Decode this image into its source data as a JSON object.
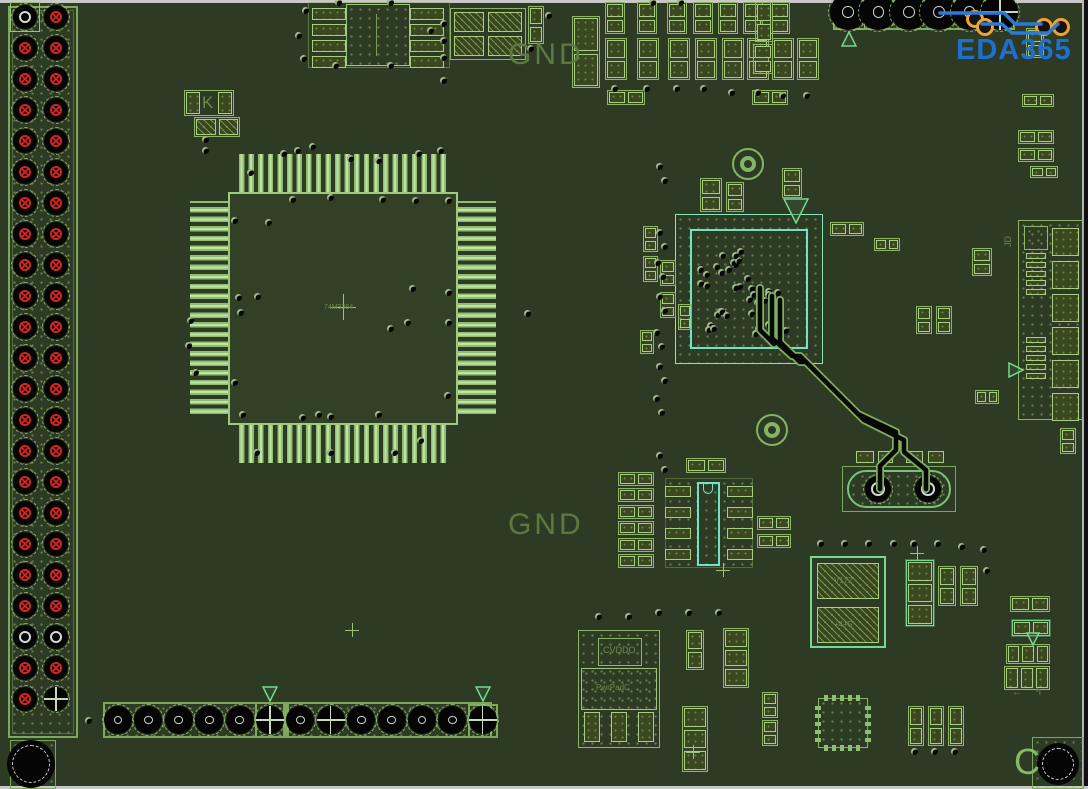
{
  "colors": {
    "board": "#2e3b24",
    "outline": "#8fb468",
    "bright": "#74da90",
    "cyan": "#6fe3c3",
    "silkscreen": "#5c7a40",
    "red_pad": "#d42525",
    "orange_via": "#f0a332",
    "blue_trace": "#2b79d8",
    "logo_blue": "#1d6fd2",
    "black": "#070707",
    "white_ring": "#d8d8d8"
  },
  "labels": {
    "gnd_top": "GND",
    "gnd_bottom": "GND",
    "logo": "EDA365"
  },
  "micro_labels": [
    {
      "text": "CVDDO",
      "x": 603,
      "y": 646,
      "size": 9
    },
    {
      "text": "PwrPadC",
      "x": 596,
      "y": 684,
      "size": 8
    },
    {
      "text": "V172",
      "x": 834,
      "y": 577,
      "size": 8
    },
    {
      "text": "+4+5",
      "x": 834,
      "y": 621,
      "size": 8
    },
    {
      "text": "74M9364",
      "x": 324,
      "y": 304,
      "size": 7
    },
    {
      "text": "K",
      "x": 202,
      "y": 94,
      "size": 17
    },
    {
      "text": "JD",
      "x": 1004,
      "y": 236,
      "size": 9,
      "rot": true
    },
    {
      "text": "C",
      "x": 1014,
      "y": 744,
      "size": 36,
      "bright": true
    },
    {
      "text": "←",
      "x": 1012,
      "y": 688,
      "size": 10
    },
    {
      "text": "↰",
      "x": 1034,
      "y": 688,
      "size": 10
    }
  ],
  "left_header": {
    "x": 8,
    "y": 6,
    "w": 70,
    "h": 732,
    "cols": [
      25,
      56
    ],
    "row_start": 17,
    "row_step": 31,
    "rows": 23,
    "pad_size": 24,
    "white_rows": [
      20
    ],
    "pin1": {
      "row": 0,
      "col": 0
    },
    "cross_pads": [
      {
        "row": 22,
        "col": 1
      }
    ]
  },
  "top_header": {
    "box": {
      "x": 833,
      "y": 0,
      "w": 182,
      "h": 30
    },
    "pin1_box": {
      "x": 833,
      "y": 0,
      "w": 32,
      "h": 30
    },
    "y": 12,
    "x_start": 848,
    "x_step": 30.4,
    "n": 6,
    "pad_size": 36,
    "cross_index": 5
  },
  "bottom_header": {
    "boxes": [
      {
        "x": 103,
        "y": 702,
        "w": 182,
        "h": 36
      },
      {
        "x": 287,
        "y": 702,
        "w": 205,
        "h": 36
      },
      {
        "x": 255,
        "y": 702,
        "w": 32,
        "h": 36
      },
      {
        "x": 468,
        "y": 704,
        "w": 30,
        "h": 34
      }
    ],
    "y": 720,
    "x_start": 118,
    "x_step": 30.4,
    "n": 13,
    "pad_size": 28,
    "cross_indices": [
      5,
      7,
      12
    ]
  },
  "qfp": {
    "body": {
      "x": 228,
      "y": 192,
      "w": 230,
      "h": 233
    },
    "strips": {
      "top": {
        "x": 237,
        "y": 154,
        "w": 212,
        "h": 38
      },
      "bottom": {
        "x": 237,
        "y": 425,
        "w": 212,
        "h": 38
      },
      "left": {
        "x": 190,
        "y": 201,
        "w": 38,
        "h": 215
      },
      "right": {
        "x": 458,
        "y": 201,
        "w": 38,
        "h": 215
      }
    },
    "center": {
      "x": 343,
      "y": 307
    }
  },
  "bga": {
    "outer": {
      "x": 675,
      "y": 214,
      "w": 148,
      "h": 150
    },
    "inner": {
      "x": 690,
      "y": 229,
      "w": 118,
      "h": 120
    },
    "clusters": [
      {
        "cx": 735,
        "cy": 262,
        "n": 8
      },
      {
        "cx": 762,
        "cy": 300,
        "n": 9
      },
      {
        "cx": 722,
        "cy": 318,
        "n": 8
      },
      {
        "cx": 770,
        "cy": 335,
        "n": 7
      },
      {
        "cx": 708,
        "cy": 276,
        "n": 5
      },
      {
        "cx": 745,
        "cy": 290,
        "n": 6
      }
    ]
  },
  "jd_connector": {
    "outline": {
      "x": 1018,
      "y": 220,
      "w": 66,
      "h": 200
    },
    "big_pads": {
      "x": 1052,
      "w": 27,
      "h": 28,
      "y_start": 228,
      "y_step": 33,
      "n": 6
    },
    "small_square": {
      "x": 1024,
      "y": 226,
      "w": 24,
      "h": 24
    },
    "bar_groups": [
      {
        "x": 1026,
        "y_start": 253,
        "n": 5
      },
      {
        "x": 1026,
        "y_start": 337,
        "n": 5
      }
    ],
    "bar": {
      "w": 20,
      "h": 6,
      "step": 9
    }
  },
  "soic8": {
    "outer": {
      "x": 308,
      "y": 2,
      "w": 142,
      "h": 66
    },
    "body": {
      "x": 346,
      "y": 4,
      "w": 64,
      "h": 62
    },
    "pads_left_x": 312,
    "pads_right_x": 410,
    "pad_w": 34,
    "pad_h": 12,
    "pad_ys": [
      8,
      24,
      40,
      56
    ]
  },
  "soic14": {
    "court": {
      "x": 665,
      "y": 478,
      "w": 88,
      "h": 90
    },
    "body": {
      "x": 697,
      "y": 482,
      "w": 23,
      "h": 84
    },
    "pads_left_x": 665,
    "pads_right_x": 727,
    "pad_w": 26,
    "pad_h": 11,
    "pad_ys": [
      486,
      507,
      528,
      549
    ]
  },
  "regulator": {
    "outer": {
      "x": 578,
      "y": 630,
      "w": 82,
      "h": 118
    },
    "label_box": {
      "x": 598,
      "y": 638,
      "w": 44,
      "h": 28
    },
    "tab_pad": {
      "x": 581,
      "y": 668,
      "w": 76,
      "h": 42
    },
    "pins": [
      {
        "x": 584,
        "y": 712,
        "w": 16,
        "h": 30
      },
      {
        "x": 611,
        "y": 712,
        "w": 16,
        "h": 30
      },
      {
        "x": 638,
        "y": 712,
        "w": 16,
        "h": 30
      }
    ]
  },
  "crystal": {
    "outer": {
      "x": 842,
      "y": 466,
      "w": 114,
      "h": 46
    },
    "oval": {
      "x": 847,
      "y": 470,
      "w": 104,
      "h": 38
    },
    "pads": [
      {
        "cx": 878,
        "cy": 489
      },
      {
        "cx": 928,
        "cy": 489
      }
    ],
    "top_pads": [
      {
        "x": 856,
        "y": 451,
        "w": 18,
        "h": 12
      },
      {
        "x": 878,
        "y": 451,
        "w": 15,
        "h": 12
      },
      {
        "x": 906,
        "y": 451,
        "w": 17,
        "h": 12
      },
      {
        "x": 928,
        "y": 451,
        "w": 16,
        "h": 12
      }
    ]
  },
  "v1_comp": {
    "outer": {
      "x": 810,
      "y": 556,
      "w": 76,
      "h": 92
    },
    "pads": [
      {
        "x": 817,
        "y": 563,
        "w": 62,
        "h": 36
      },
      {
        "x": 817,
        "y": 607,
        "w": 62,
        "h": 36
      }
    ]
  },
  "qfn": {
    "x": 818,
    "y": 698,
    "w": 50,
    "h": 50
  },
  "quad_comp": {
    "outer": {
      "x": 450,
      "y": 8,
      "w": 76,
      "h": 52
    },
    "pads": [
      {
        "x": 454,
        "y": 12,
        "w": 30,
        "h": 20
      },
      {
        "x": 488,
        "y": 12,
        "w": 34,
        "h": 20
      },
      {
        "x": 454,
        "y": 36,
        "w": 30,
        "h": 20
      },
      {
        "x": 488,
        "y": 36,
        "w": 34,
        "h": 20
      }
    ]
  },
  "k_comp": {
    "outer": {
      "x": 184,
      "y": 90,
      "w": 50,
      "h": 26
    }
  },
  "mount_holes": [
    {
      "cx": 31,
      "cy": 764,
      "r": 24,
      "square": {
        "x": 10,
        "y": 740,
        "w": 46,
        "h": 49
      }
    },
    {
      "cx": 1058,
      "cy": 764,
      "r": 21,
      "square": {
        "x": 1032,
        "y": 737,
        "w": 52,
        "h": 52
      }
    }
  ],
  "donuts": [
    {
      "cx": 748,
      "cy": 164
    },
    {
      "cx": 772,
      "cy": 430
    }
  ],
  "triangles": [
    {
      "x": 841,
      "y": 31,
      "dir": "up",
      "s": 16
    },
    {
      "x": 262,
      "y": 686,
      "dir": "down",
      "s": 16
    },
    {
      "x": 475,
      "y": 686,
      "dir": "down",
      "s": 16
    },
    {
      "x": 783,
      "y": 198,
      "dir": "down",
      "s": 26
    },
    {
      "x": 1008,
      "y": 362,
      "dir": "right",
      "s": 16
    },
    {
      "x": 1026,
      "y": 632,
      "dir": "down",
      "s": 14
    }
  ],
  "plus_marks": [
    [
      693,
      752
    ],
    [
      917,
      553
    ],
    [
      723,
      570
    ],
    [
      352,
      630
    ]
  ],
  "components": [
    {
      "t": "v2",
      "x": 528,
      "y": 6,
      "w": 16,
      "h": 38
    },
    {
      "t": "v2",
      "x": 572,
      "y": 16,
      "w": 28,
      "h": 72
    },
    {
      "t": "v2",
      "x": 605,
      "y": 2,
      "w": 20,
      "h": 32
    },
    {
      "t": "v2",
      "x": 637,
      "y": 2,
      "w": 20,
      "h": 32
    },
    {
      "t": "v2",
      "x": 667,
      "y": 2,
      "w": 20,
      "h": 32
    },
    {
      "t": "v2",
      "x": 693,
      "y": 2,
      "w": 20,
      "h": 32
    },
    {
      "t": "v2",
      "x": 718,
      "y": 2,
      "w": 20,
      "h": 32
    },
    {
      "t": "v2",
      "x": 743,
      "y": 2,
      "w": 20,
      "h": 32
    },
    {
      "t": "v2",
      "x": 770,
      "y": 2,
      "w": 20,
      "h": 32
    },
    {
      "t": "v2",
      "x": 605,
      "y": 38,
      "w": 22,
      "h": 42
    },
    {
      "t": "v2",
      "x": 637,
      "y": 38,
      "w": 22,
      "h": 42
    },
    {
      "t": "v2",
      "x": 668,
      "y": 38,
      "w": 22,
      "h": 42
    },
    {
      "t": "v2",
      "x": 695,
      "y": 38,
      "w": 22,
      "h": 42
    },
    {
      "t": "v2",
      "x": 722,
      "y": 38,
      "w": 22,
      "h": 42
    },
    {
      "t": "v2",
      "x": 747,
      "y": 38,
      "w": 22,
      "h": 42
    },
    {
      "t": "v2",
      "x": 772,
      "y": 38,
      "w": 22,
      "h": 42
    },
    {
      "t": "v2",
      "x": 797,
      "y": 38,
      "w": 22,
      "h": 42
    },
    {
      "t": "h2",
      "x": 607,
      "y": 90,
      "w": 38,
      "h": 15
    },
    {
      "t": "h2",
      "x": 752,
      "y": 90,
      "w": 36,
      "h": 15
    },
    {
      "t": "v2",
      "x": 755,
      "y": 2,
      "w": 18,
      "h": 40
    },
    {
      "t": "v2",
      "x": 753,
      "y": 44,
      "w": 20,
      "h": 30
    },
    {
      "t": "v2",
      "x": 1026,
      "y": 28,
      "w": 18,
      "h": 30
    },
    {
      "t": "h2",
      "x": 1022,
      "y": 94,
      "w": 32,
      "h": 13
    },
    {
      "t": "h2",
      "x": 1018,
      "y": 130,
      "w": 36,
      "h": 14
    },
    {
      "t": "h2",
      "x": 1018,
      "y": 148,
      "w": 36,
      "h": 14
    },
    {
      "t": "h2",
      "x": 1030,
      "y": 166,
      "w": 28,
      "h": 12
    },
    {
      "t": "v2",
      "x": 700,
      "y": 178,
      "w": 22,
      "h": 34
    },
    {
      "t": "v2",
      "x": 726,
      "y": 182,
      "w": 18,
      "h": 30
    },
    {
      "t": "v2",
      "x": 782,
      "y": 168,
      "w": 20,
      "h": 30
    },
    {
      "t": "h2",
      "x": 830,
      "y": 222,
      "w": 34,
      "h": 14
    },
    {
      "t": "h2",
      "x": 874,
      "y": 238,
      "w": 26,
      "h": 13
    },
    {
      "t": "v2",
      "x": 972,
      "y": 248,
      "w": 20,
      "h": 28
    },
    {
      "t": "v2",
      "x": 916,
      "y": 306,
      "w": 16,
      "h": 28
    },
    {
      "t": "v2",
      "x": 936,
      "y": 306,
      "w": 16,
      "h": 28
    },
    {
      "t": "v2",
      "x": 660,
      "y": 260,
      "w": 16,
      "h": 26
    },
    {
      "t": "v2",
      "x": 660,
      "y": 292,
      "w": 16,
      "h": 26
    },
    {
      "t": "v2",
      "x": 678,
      "y": 304,
      "w": 14,
      "h": 26
    },
    {
      "t": "v2",
      "x": 640,
      "y": 330,
      "w": 14,
      "h": 24
    },
    {
      "t": "v2",
      "x": 643,
      "y": 226,
      "w": 15,
      "h": 26
    },
    {
      "t": "v2",
      "x": 643,
      "y": 256,
      "w": 15,
      "h": 26
    },
    {
      "t": "h2",
      "x": 686,
      "y": 458,
      "w": 40,
      "h": 15
    },
    {
      "t": "h2",
      "x": 618,
      "y": 472,
      "w": 36,
      "h": 14
    },
    {
      "t": "h2",
      "x": 618,
      "y": 488,
      "w": 36,
      "h": 14
    },
    {
      "t": "h2",
      "x": 618,
      "y": 505,
      "w": 36,
      "h": 14
    },
    {
      "t": "h2",
      "x": 618,
      "y": 521,
      "w": 36,
      "h": 14
    },
    {
      "t": "h2",
      "x": 618,
      "y": 538,
      "w": 36,
      "h": 14
    },
    {
      "t": "h2",
      "x": 618,
      "y": 554,
      "w": 36,
      "h": 14
    },
    {
      "t": "h2",
      "x": 757,
      "y": 516,
      "w": 34,
      "h": 14
    },
    {
      "t": "h2",
      "x": 757,
      "y": 534,
      "w": 34,
      "h": 14
    },
    {
      "t": "v2",
      "x": 686,
      "y": 630,
      "w": 18,
      "h": 40
    },
    {
      "t": "v3",
      "x": 682,
      "y": 706,
      "w": 26,
      "h": 66
    },
    {
      "t": "v3",
      "x": 723,
      "y": 628,
      "w": 26,
      "h": 60
    },
    {
      "t": "v2",
      "x": 762,
      "y": 692,
      "w": 16,
      "h": 26
    },
    {
      "t": "v2",
      "x": 762,
      "y": 720,
      "w": 16,
      "h": 26
    },
    {
      "t": "v3",
      "x": 906,
      "y": 560,
      "w": 28,
      "h": 66,
      "b": 1
    },
    {
      "t": "v2",
      "x": 938,
      "y": 566,
      "w": 18,
      "h": 40
    },
    {
      "t": "v2",
      "x": 960,
      "y": 566,
      "w": 18,
      "h": 40
    },
    {
      "t": "h2",
      "x": 1010,
      "y": 596,
      "w": 40,
      "h": 16
    },
    {
      "t": "h2",
      "x": 1012,
      "y": 620,
      "w": 38,
      "h": 16,
      "b": 1
    },
    {
      "t": "h3",
      "x": 1006,
      "y": 644,
      "w": 44,
      "h": 20
    },
    {
      "t": "h3",
      "x": 1004,
      "y": 666,
      "w": 46,
      "h": 24
    },
    {
      "t": "v2",
      "x": 908,
      "y": 706,
      "w": 16,
      "h": 40
    },
    {
      "t": "v2",
      "x": 928,
      "y": 706,
      "w": 16,
      "h": 40
    },
    {
      "t": "v2",
      "x": 948,
      "y": 706,
      "w": 16,
      "h": 40
    },
    {
      "t": "v2",
      "x": 1060,
      "y": 428,
      "w": 16,
      "h": 26
    },
    {
      "t": "h2",
      "x": 975,
      "y": 390,
      "w": 24,
      "h": 14
    },
    {
      "t": "h2",
      "x": 194,
      "y": 117,
      "w": 46,
      "h": 20,
      "hatch": 1
    }
  ],
  "vias": [
    [
      250,
      172
    ],
    [
      283,
      153
    ],
    [
      297,
      150
    ],
    [
      312,
      146
    ],
    [
      350,
      158
    ],
    [
      378,
      160
    ],
    [
      418,
      153
    ],
    [
      440,
      150
    ],
    [
      292,
      199
    ],
    [
      330,
      197
    ],
    [
      382,
      199
    ],
    [
      415,
      200
    ],
    [
      448,
      200
    ],
    [
      234,
      220
    ],
    [
      268,
      222
    ],
    [
      238,
      297
    ],
    [
      257,
      296
    ],
    [
      240,
      312
    ],
    [
      412,
      288
    ],
    [
      448,
      292
    ],
    [
      407,
      322
    ],
    [
      448,
      322
    ],
    [
      234,
      382
    ],
    [
      242,
      414
    ],
    [
      302,
      417
    ],
    [
      318,
      414
    ],
    [
      330,
      416
    ],
    [
      378,
      414
    ],
    [
      390,
      328
    ],
    [
      447,
      395
    ],
    [
      256,
      452
    ],
    [
      330,
      452
    ],
    [
      394,
      452
    ],
    [
      420,
      440
    ],
    [
      205,
      150
    ],
    [
      190,
      320
    ],
    [
      188,
      345
    ],
    [
      195,
      372
    ],
    [
      305,
      10
    ],
    [
      298,
      35
    ],
    [
      303,
      58
    ],
    [
      338,
      2
    ],
    [
      390,
      2
    ],
    [
      430,
      30
    ],
    [
      335,
      65
    ],
    [
      390,
      65
    ],
    [
      443,
      23
    ],
    [
      443,
      40
    ],
    [
      443,
      57
    ],
    [
      443,
      80
    ],
    [
      548,
      15
    ],
    [
      530,
      48
    ],
    [
      614,
      88
    ],
    [
      646,
      88
    ],
    [
      676,
      88
    ],
    [
      703,
      88
    ],
    [
      731,
      92
    ],
    [
      757,
      92
    ],
    [
      782,
      95
    ],
    [
      806,
      95
    ],
    [
      652,
      2
    ],
    [
      680,
      2
    ],
    [
      659,
      166
    ],
    [
      664,
      180
    ],
    [
      659,
      232
    ],
    [
      664,
      246
    ],
    [
      657,
      262
    ],
    [
      662,
      276
    ],
    [
      659,
      296
    ],
    [
      664,
      310
    ],
    [
      656,
      332
    ],
    [
      661,
      346
    ],
    [
      659,
      366
    ],
    [
      664,
      380
    ],
    [
      656,
      398
    ],
    [
      661,
      412
    ],
    [
      659,
      455
    ],
    [
      664,
      469
    ],
    [
      598,
      616
    ],
    [
      628,
      616
    ],
    [
      658,
      612
    ],
    [
      688,
      612
    ],
    [
      718,
      612
    ],
    [
      820,
      543
    ],
    [
      844,
      543
    ],
    [
      868,
      543
    ],
    [
      893,
      543
    ],
    [
      913,
      543
    ],
    [
      937,
      543
    ],
    [
      961,
      546
    ],
    [
      983,
      549
    ],
    [
      986,
      570
    ],
    [
      527,
      313
    ],
    [
      88,
      720
    ],
    [
      205,
      139
    ],
    [
      914,
      751
    ],
    [
      934,
      751
    ],
    [
      954,
      751
    ]
  ],
  "orange_vias": [
    [
      972,
      16
    ],
    [
      982,
      24
    ],
    [
      1041,
      24
    ],
    [
      1058,
      24
    ]
  ],
  "traces": {
    "black": [
      "M772,296 L772,338 L792,356 L800,356 L858,414 L896,432 L896,450 L880,466 L880,489",
      "M780,300 L780,342 L800,362 L806,362 L864,420 L904,440 L904,452 L926,470 L926,489",
      "M760,288 L760,330 L774,344"
    ],
    "blue": [
      "M940,13 L1004,13 L1015,24 L1041,24",
      "M982,24 L1002,24 L1012,33 L1048,33 L1058,24"
    ]
  }
}
